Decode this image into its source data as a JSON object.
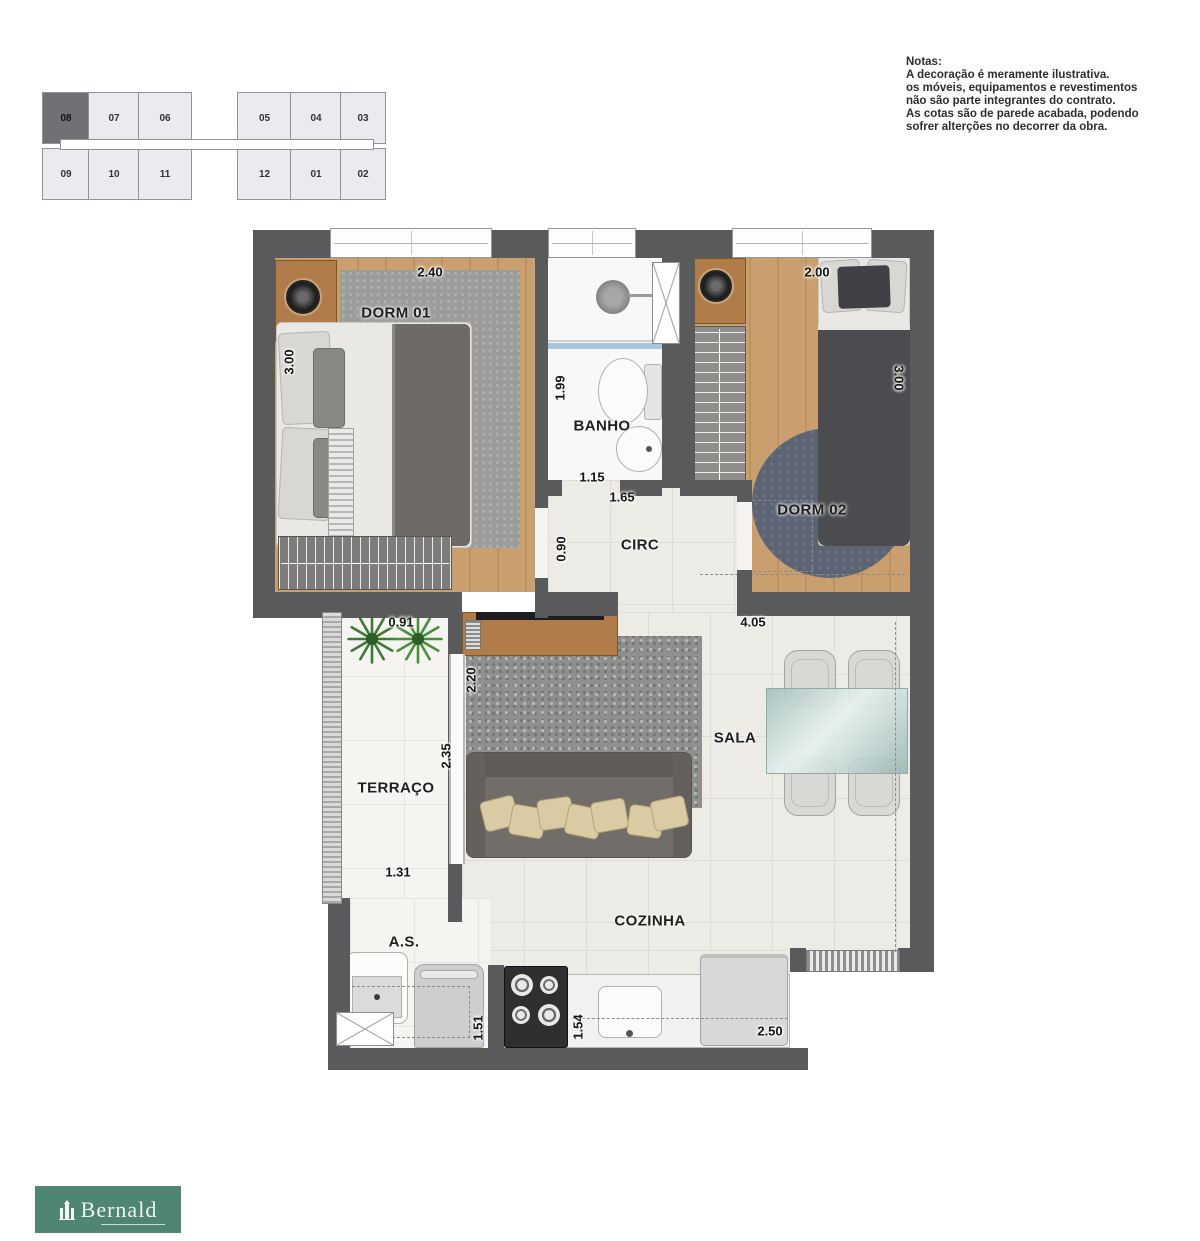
{
  "key_plan": {
    "highlighted_unit": "08",
    "top_row": [
      "08",
      "07",
      "06",
      "05",
      "04",
      "03"
    ],
    "bottom_row": [
      "09",
      "10",
      "11",
      "12",
      "01",
      "02"
    ]
  },
  "notes": {
    "title": "Notas:",
    "lines": [
      "A decoração é meramente ilustrativa.",
      "os móveis, equipamentos e revestimentos",
      "não são parte integrantes do contrato.",
      "As cotas são de parede acabada, podendo",
      "sofrer alterções no decorrer da obra."
    ]
  },
  "rooms": {
    "dorm1": {
      "label": "DORM 01",
      "dim_width": "2.40",
      "dim_depth": "3.00"
    },
    "banho": {
      "label": "BANHO",
      "dim_depth": "1.99",
      "dim_width": "1.15"
    },
    "dorm2": {
      "label": "DORM 02",
      "dim_width": "2.00",
      "dim_depth": "3.00"
    },
    "circ": {
      "label": "CIRC",
      "dim_width": "1.65",
      "dim_depth": "0.90"
    },
    "terraco": {
      "label": "TERRAÇO",
      "dim_top": "0.91",
      "dim_depth": "2.35",
      "dim_bottom": "1.31"
    },
    "sala": {
      "label": "SALA",
      "dim_width": "4.05",
      "dim_tv": "2.20"
    },
    "cozinha": {
      "label": "COZINHA",
      "dim_counter": "1.54",
      "dim_width": "2.50"
    },
    "servico": {
      "label": "A.S.",
      "dim_depth": "1.51"
    }
  },
  "logo": {
    "brand": "Bernald"
  },
  "colors": {
    "wall": "#595a5c",
    "wood": "#c99f6f",
    "tile": "#edebe6",
    "rug_blue": "#5c6474",
    "logo_green": "#4f8672"
  }
}
